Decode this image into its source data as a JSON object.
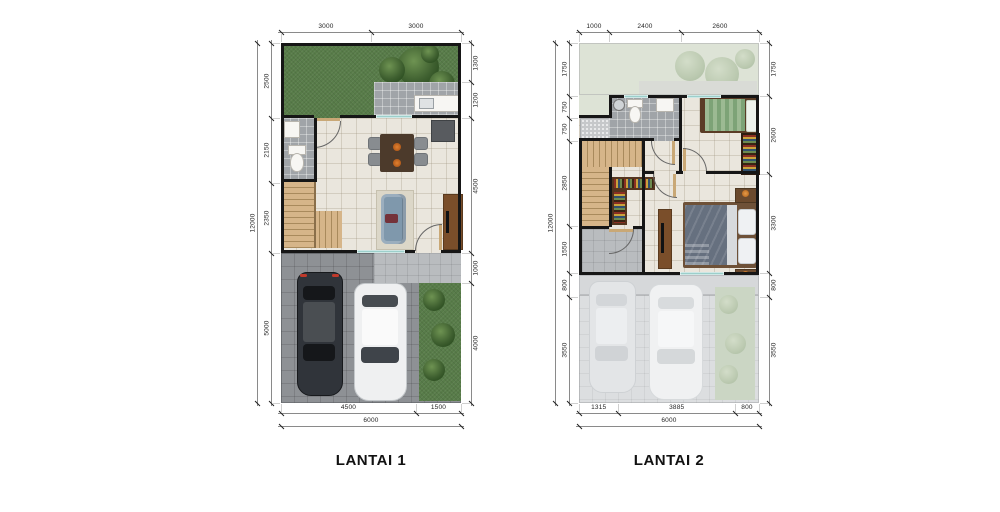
{
  "colors": {
    "wall": "#161616",
    "grass": "#587c49",
    "grass_faded": "#dde3d6",
    "tile_cream": "#eae6dd",
    "tile_gray": "#a0a4a8",
    "tile_light": "#b9bcbf",
    "carport": "#8e9195",
    "carport_faded": "#dcdee0",
    "wood": "#d6b589",
    "wood_dark": "#a98a5c",
    "door": "#c9a876",
    "window": "#9ccfcb",
    "sofa": "#7f98ac",
    "rug": "#dcd7c8",
    "table_dark": "#4c3a2b",
    "console": "#7a4e2a",
    "bed_blanket": "#66707f",
    "bed_green": "#9cba93",
    "shelf": "#54351f",
    "car_dark": "#30343a",
    "car_light": "#eff0f1",
    "dim_text": "#1f1f1f",
    "dim_line": "#8a8a8a"
  },
  "floors": [
    {
      "id": "lantai1",
      "label": "LANTAI 1",
      "dims": {
        "top": {
          "segments": [
            "3000",
            "3000"
          ]
        },
        "bottom": {
          "segments": [
            "4500",
            "1500"
          ],
          "total": "6000"
        },
        "left": {
          "segments": [
            "2500",
            "2150",
            "2350",
            "5000"
          ],
          "total": "12000"
        },
        "right": {
          "segments": [
            "1300",
            "1200",
            "4500",
            "1000",
            "4000"
          ]
        }
      },
      "rooms": [
        "garden",
        "kitchen-terrace",
        "bathroom",
        "living-dining",
        "stairs",
        "terrace",
        "carport",
        "planting-strip"
      ]
    },
    {
      "id": "lantai2",
      "label": "LANTAI 2",
      "dims": {
        "top": {
          "segments": [
            "1000",
            "2400",
            "2600"
          ]
        },
        "bottom": {
          "segments": [
            "1315",
            "3885",
            "800"
          ],
          "total": "6000"
        },
        "left": {
          "segments": [
            "1750",
            "750",
            "750",
            "2850",
            "1550",
            "800",
            "3550"
          ],
          "total": "12000"
        },
        "right": {
          "segments": [
            "1750",
            "2600",
            "3300",
            "800",
            "3550"
          ]
        }
      },
      "rooms": [
        "roof-garden",
        "service-area",
        "bathroom",
        "bedroom-2",
        "stairs",
        "hall",
        "master-bedroom",
        "balcony",
        "carport-below",
        "planting-strip"
      ]
    }
  ]
}
